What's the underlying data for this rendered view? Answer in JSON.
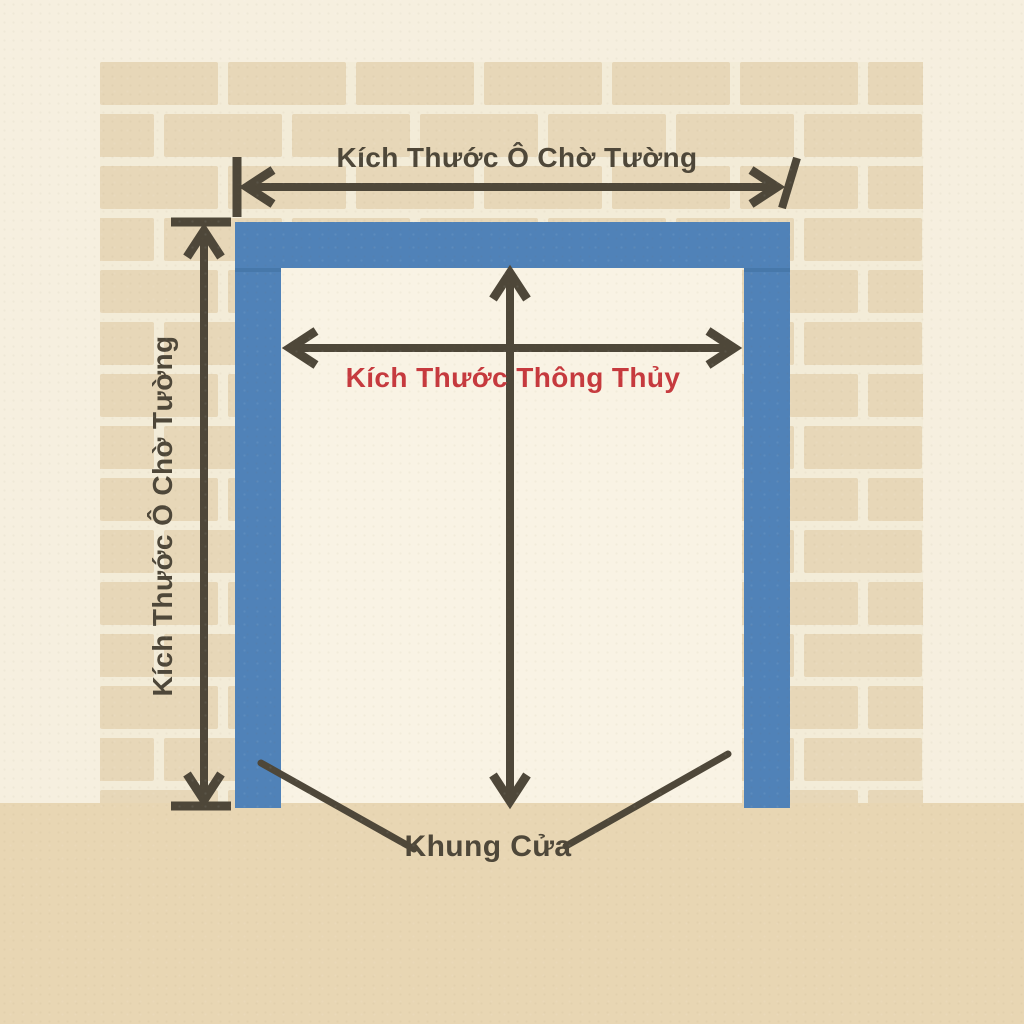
{
  "diagram": {
    "title": "Door frame measurement diagram",
    "labels": {
      "wall_opening_width": "Kích Thước Ô Chờ Tường",
      "wall_opening_height": "Kích Thước Ô Chờ Tường",
      "clear_opening": "Kích Thước Thông Thủy",
      "door_frame": "Khung Cửa"
    },
    "colors": {
      "background": "#f6efdf",
      "brick": "#e7d7b8",
      "mortar": "#f3ecd8",
      "floor": "#e8d6b3",
      "opening": "#f9f3e4",
      "frame_blue": "#5082b8",
      "frame_blue_seam": "#40719f",
      "arrow_dark": "#4e4739",
      "label_red": "#c63a3e"
    }
  }
}
